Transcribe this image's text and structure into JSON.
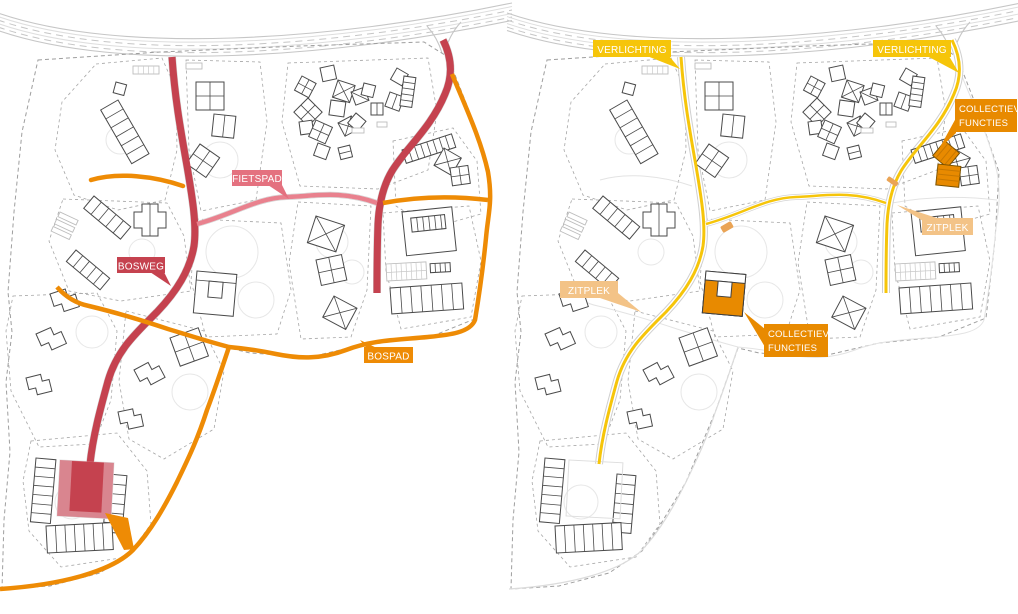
{
  "left_map": {
    "name": "routes-plan",
    "labels": {
      "bosweg": "BOSWEG",
      "fietspad": "FIETSPAD",
      "bospad": "BOSPAD"
    }
  },
  "right_map": {
    "name": "amenities-plan",
    "labels": {
      "verlichting_1": "VERLICHTING",
      "verlichting_2": "VERLICHTING",
      "collectieve_functies_1": {
        "line1": "COLLECTIEVE",
        "line2": "FUNCTIES"
      },
      "collectieve_functies_2": {
        "line1": "COLLECTIEVE",
        "line2": "FUNCTIES"
      },
      "zitplek_1": "ZITPLEK",
      "zitplek_2": "ZITPLEK"
    }
  },
  "colors": {
    "bosweg_red": "#c5424f",
    "bosweg_label": "#c5424f",
    "plaza_light_red": "#d9858f",
    "fietspad_pink": "#e9818e",
    "fietspad_label": "#e4717f",
    "bospad_orange": "#ee8b05",
    "verlichting_yellow": "#f6c50a",
    "collectief_orange": "#e88a00",
    "zitplek_tan": "#f3c387",
    "mark_orange": "#eaa455"
  }
}
